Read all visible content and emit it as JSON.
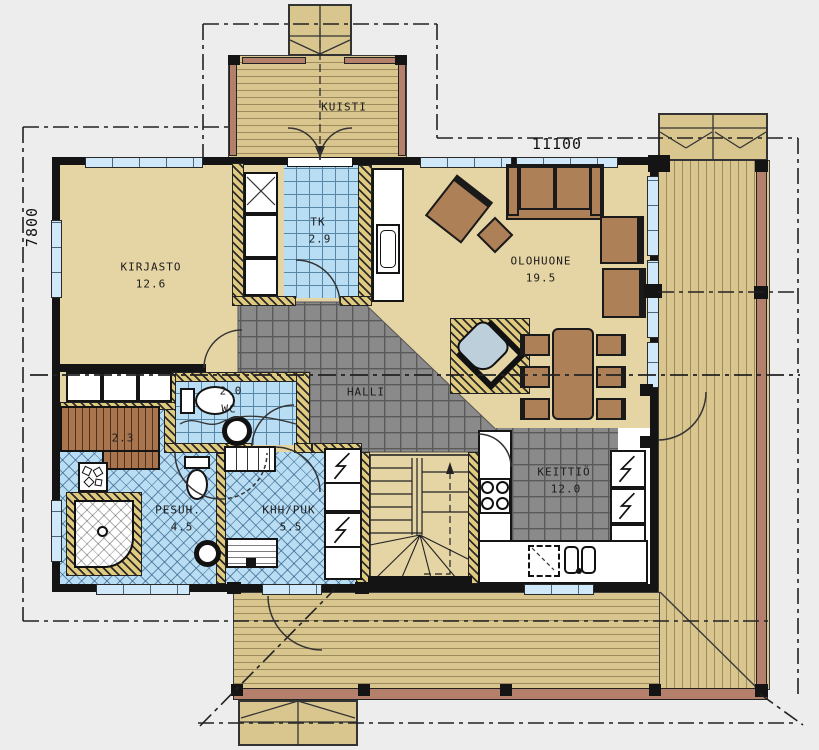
{
  "plan": {
    "dimensions": {
      "width": "11100",
      "depth": "7800"
    },
    "rooms": {
      "kuisti": {
        "name": "KUISTI"
      },
      "kirjasto": {
        "name": "KIRJASTO",
        "area": "12.6"
      },
      "tk": {
        "name": "TK",
        "area": "2.9"
      },
      "olohuone": {
        "name": "OLOHUONE",
        "area": "19.5"
      },
      "halli": {
        "name": "HALLI"
      },
      "wc": {
        "name": "WC",
        "area": "2.0"
      },
      "sauna": {
        "area": "2.3"
      },
      "pesuhuone": {
        "name": "PESUH.",
        "area": "4.5"
      },
      "khh": {
        "name": "KHH/PUK",
        "area": "5.5"
      },
      "keittio": {
        "name": "KEITTIÖ",
        "area": "12.0"
      }
    },
    "colors": {
      "background": "#ededed",
      "wall": "#141414",
      "floor_tan": "#e5d4a4",
      "deck_wood": "#d9c68e",
      "deck_rail": "#b5806b",
      "tile_blue": "#b9ddf2",
      "tile_gray": "#8a8a8a",
      "hatch_wall": "#e0ca7e",
      "furniture_brown": "#ad8058",
      "sauna_bench": "#a9754f",
      "stove_bluegray": "#bccfdb",
      "window_blue": "#cfe9fa"
    }
  }
}
